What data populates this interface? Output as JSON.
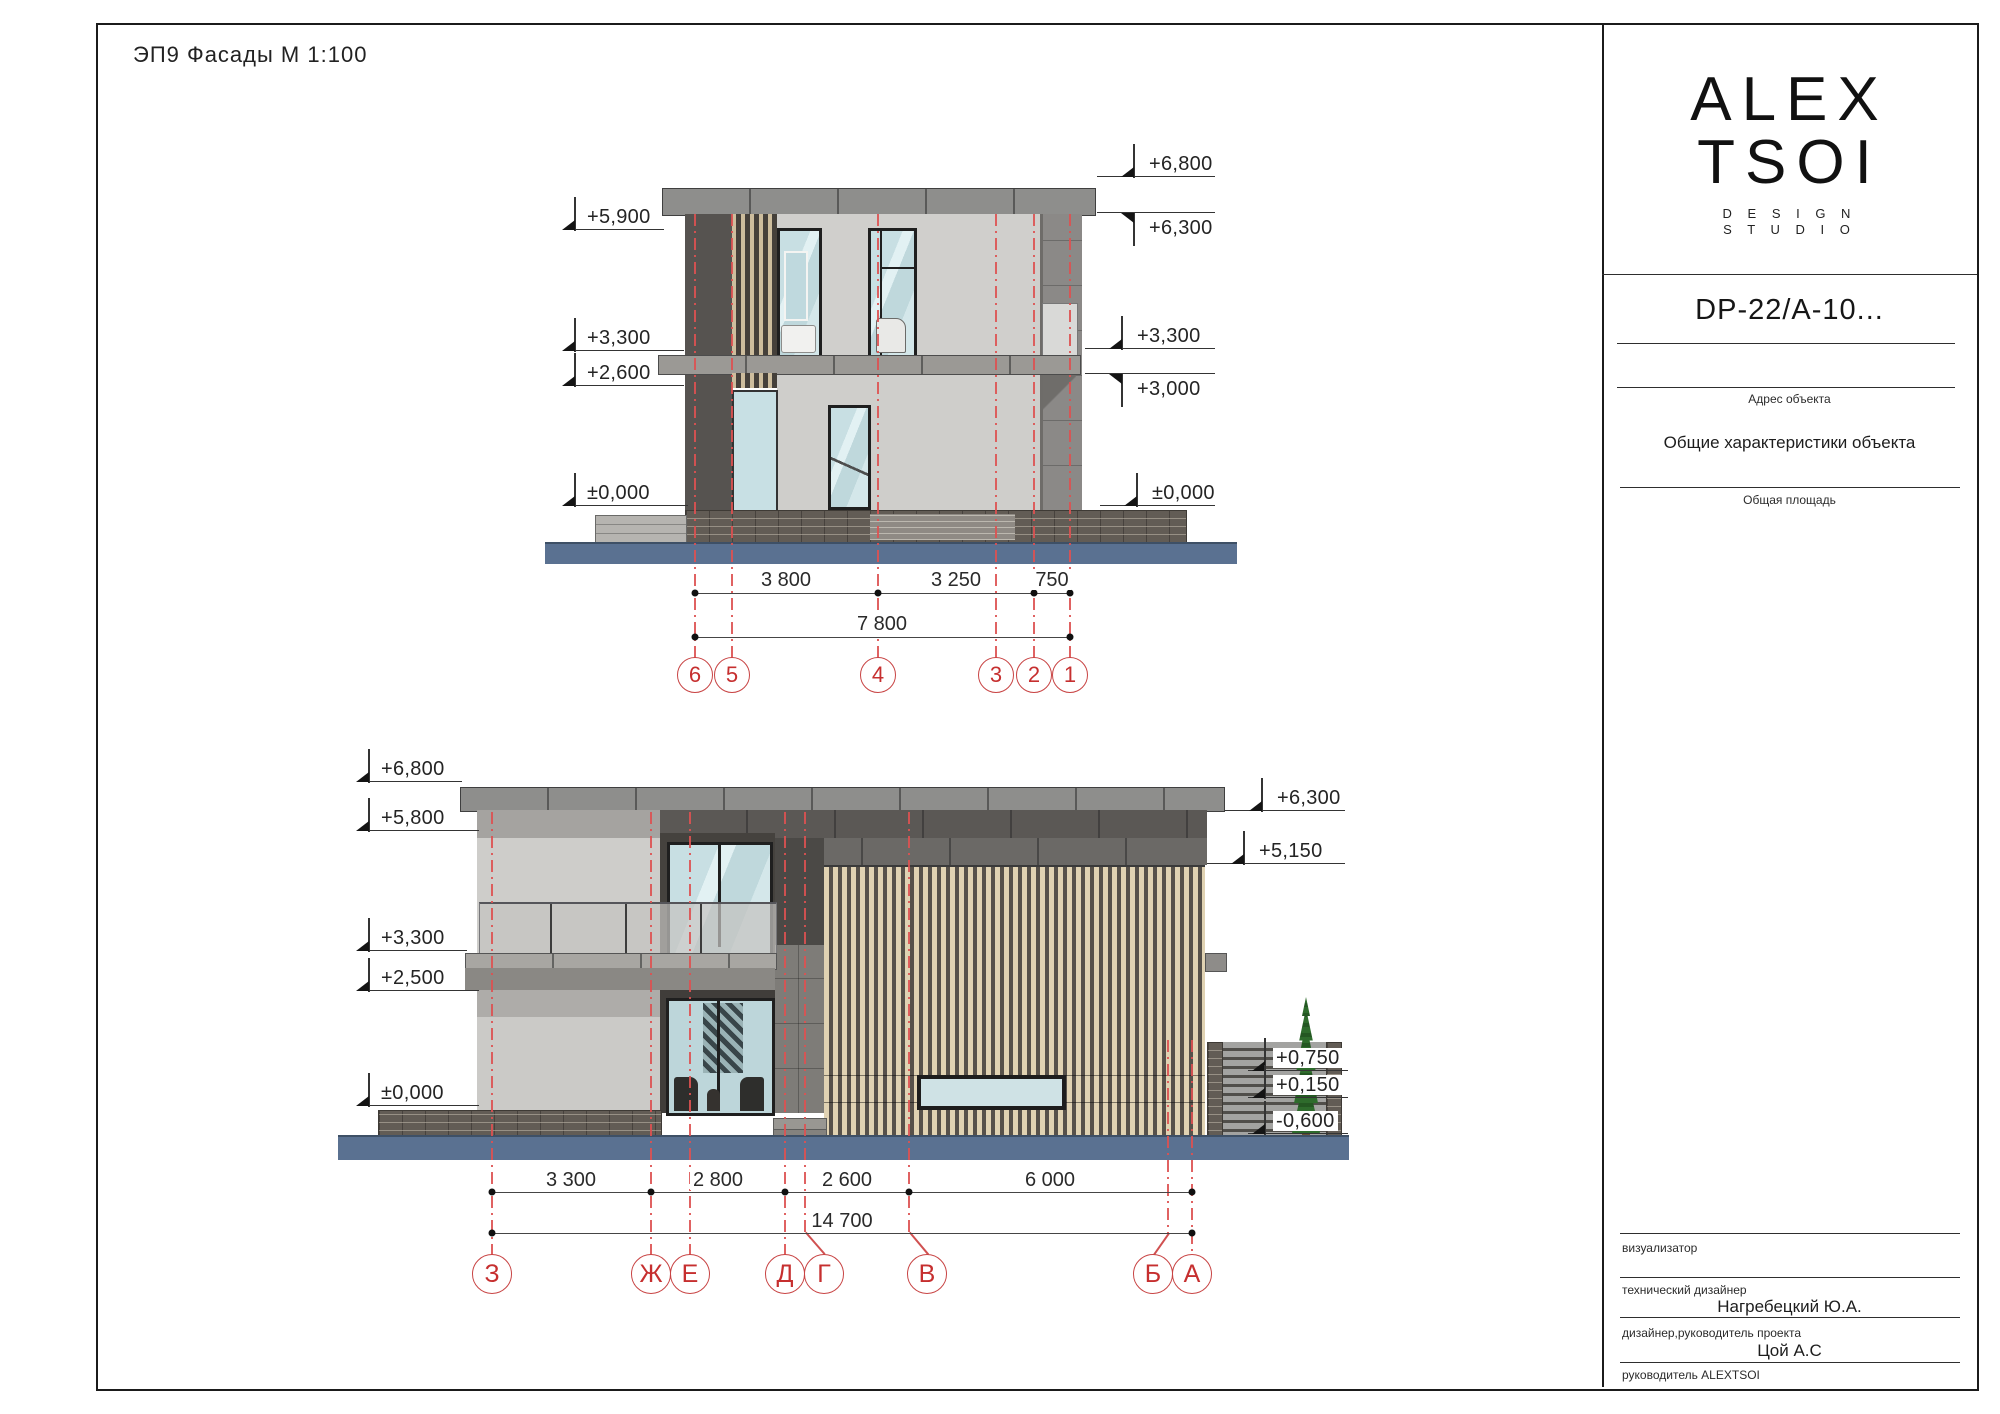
{
  "sheet": {
    "title": "ЭП9  Фасады  М 1:100"
  },
  "title_block": {
    "logo": {
      "line1": "ALEX",
      "line2": "TSOI",
      "sub1": "D E S I G N",
      "sub2": "S T U D I O"
    },
    "project_code": "DP-22/A-10...",
    "address_label": "Адрес объекта",
    "characteristics_label": "Общие характеристики объекта",
    "area_label": "Общая площадь",
    "visualizer_label": "визуализатор",
    "tech_designer_label": "технический дизайнер",
    "tech_designer_name": "Нагребецкий Ю.А.",
    "lead_designer_label": "дизайнер,руководитель проекта",
    "lead_designer_name": "Цой А.С",
    "head_label": "руководитель ALEXTSOI"
  },
  "facade_top": {
    "elev_left": [
      "+5,900",
      "+3,300",
      "+2,600",
      "±0,000"
    ],
    "elev_right": [
      "+6,800",
      "+6,300",
      "+3,300",
      "+3,000",
      "±0,000"
    ],
    "dims": [
      "3 800",
      "3 250",
      "750"
    ],
    "dims_total": "7 800",
    "axes": [
      "6",
      "5",
      "4",
      "3",
      "2",
      "1"
    ]
  },
  "facade_bottom": {
    "elev_left": [
      "+6,800",
      "+5,800",
      "+3,300",
      "+2,500",
      "±0,000"
    ],
    "elev_right": [
      "+6,300",
      "+5,150",
      "+0,750",
      "+0,150",
      "-0,600"
    ],
    "dims": [
      "3 300",
      "2 800",
      "2 600",
      "6 000"
    ],
    "dims_total": "14 700",
    "axes": [
      "З",
      "Ж",
      "Е",
      "Д",
      "Г",
      "В",
      "Б",
      "А"
    ]
  },
  "colors": {
    "axis_red": "#dd5151",
    "bubble_red": "#c62f2f",
    "ground_blue": "#5a7191",
    "roof_gray": "#8e8e8c",
    "wall_light": "#d0cfcc",
    "wall_dark": "#565350",
    "wood_tan": "#e0d2b2",
    "glass_blue": "#c8dfe3"
  }
}
